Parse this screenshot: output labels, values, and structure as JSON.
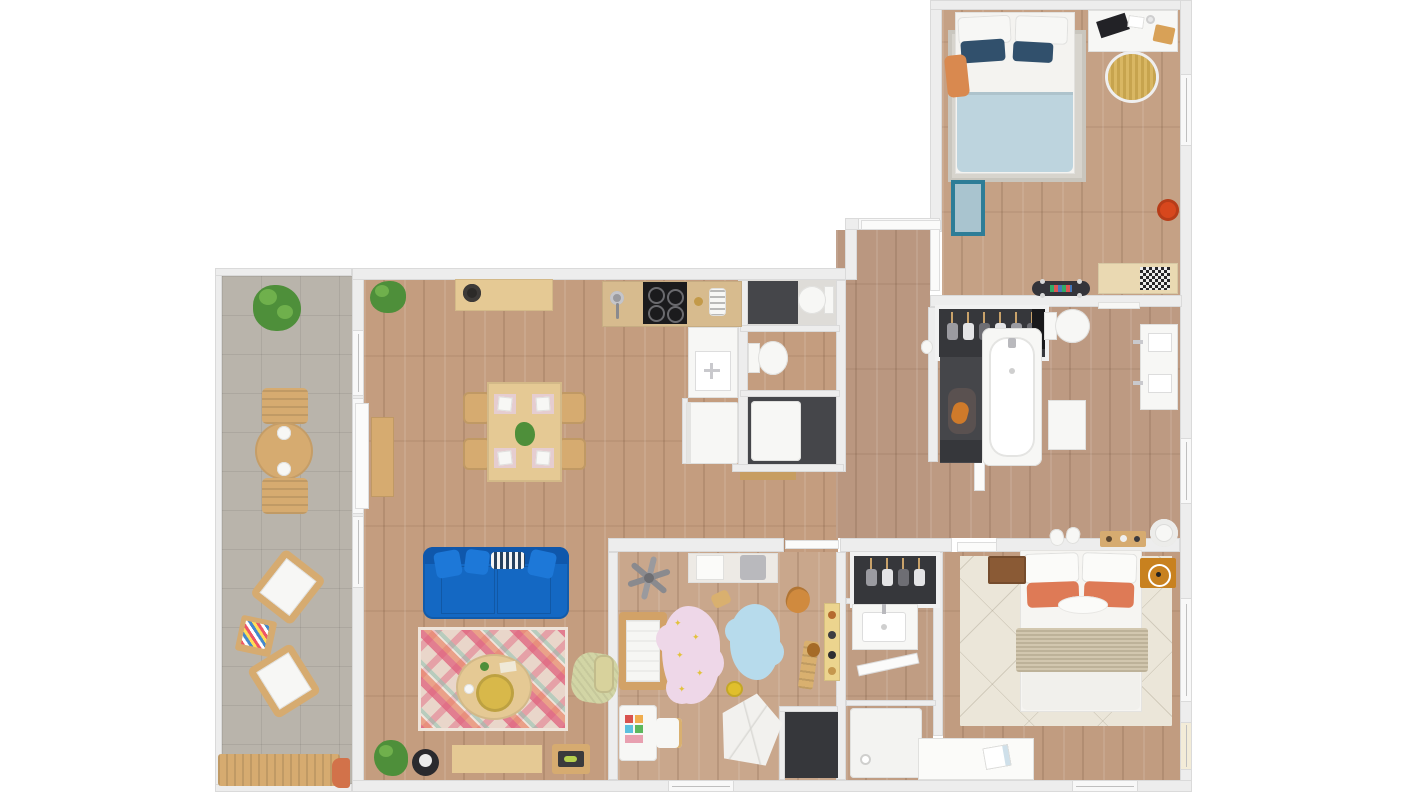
{
  "title": "apartment-floor-plan-3d-top-view",
  "palette": {
    "wall": "#ededed",
    "wall_edge": "#dadada",
    "window_band": "#f8f8f8",
    "wood_main": "#c49d7f",
    "wood_hall": "#ba9780",
    "wood_bath": "#bd9a82",
    "wood_br1": "#c5a185",
    "wood_kids": "#c9a78c",
    "wood_ensuite": "#c09d83",
    "wood_master": "#c19c80",
    "tile": "#b9b4ab",
    "dark_floor": "#45464a",
    "darker_floor": "#36373b",
    "counter_tan": "#d7bb8e",
    "wood_furniture": "#d6ab70",
    "wood_light": "#e5c994",
    "crib_wood": "#d2a267",
    "sofa_blue": "#1468c3",
    "sofa_blue_dark": "#0f57ab",
    "pillow_blue": "#1d78d8",
    "rug_base": "#e9d6ca",
    "rug_pink": "#e0607c",
    "rug_coral": "#ea8566",
    "rug_teal": "#90c3b2",
    "master_rug": "#ebe6d9",
    "throw_beige": "#cdc1a6",
    "coral_pillow": "#de7a56",
    "duvet_blue": "#bdd4de",
    "navy_pillow": "#31506c",
    "gray_rug": "#d7d4cd",
    "pink_cloud": "#eed7e8",
    "blue_cloud": "#b7dbec",
    "star_yellow": "#e2c23c",
    "wicker_yellow": "#d9b763",
    "pouf_red": "#d7471d",
    "pouf_green": "#d2d5a5",
    "amber_nightstand": "#c8811f",
    "brown_nightstand": "#8a5a35",
    "white_furniture": "#f7f7f5",
    "white_edge": "#e0e0de",
    "appliance_black": "#1b1b1d",
    "plant_green": "#4e8f3a",
    "plant_green_light": "#6fb04c",
    "terracotta": "#d2724a",
    "blue_mat": "#a9c4cf",
    "blue_mat_edge": "#2e7d97",
    "gold_tray": "#d8b84a",
    "radio_green": "#b5cf4e",
    "shelf_yellow": "#ecd48e",
    "orange_cushion": "#d9894f",
    "giraffe_orange": "#d08a3e"
  },
  "rooms": [
    {
      "name": "balcony",
      "floor": "gray tile"
    },
    {
      "name": "living-room",
      "floor": "oak plank"
    },
    {
      "name": "kitchen",
      "floor": "oak plank"
    },
    {
      "name": "dining-area",
      "floor": "oak plank"
    },
    {
      "name": "wc",
      "floor": "dark tile"
    },
    {
      "name": "shower-room",
      "floor": "dark tile"
    },
    {
      "name": "entry-hall",
      "floor": "oak plank"
    },
    {
      "name": "bedroom-1",
      "floor": "oak plank"
    },
    {
      "name": "wardrobe-closet",
      "floor": "dark tile"
    },
    {
      "name": "bathroom",
      "floor": "oak plank"
    },
    {
      "name": "kids-room",
      "floor": "oak plank"
    },
    {
      "name": "ensuite-bathroom",
      "floor": "oak plank"
    },
    {
      "name": "master-bedroom",
      "floor": "oak plank"
    },
    {
      "name": "storage-closet",
      "floor": "dark tile"
    }
  ],
  "furniture": {
    "balcony": [
      "potted plant",
      "round dining table",
      "2 outdoor chairs",
      "2 lounge chairs",
      "magazine side table",
      "wood bench",
      "terracotta pot"
    ],
    "living_room": [
      "blue 3-seat sofa",
      "kilim rug",
      "round coffee table with gold tray",
      "green woven pouf",
      "tv bench",
      "robot vacuum",
      "radio side table",
      "floor plant",
      "wall console",
      "storage basket"
    ],
    "kitchen": [
      "sideboard with bowl",
      "counter with sink",
      "induction cooktop",
      "toaster",
      "sink vanity",
      "washing machine",
      "potted plant"
    ],
    "dining_area": [
      "dining table",
      "4 chairs",
      "4 place settings",
      "plant centerpiece"
    ],
    "wc": [
      "dark counter",
      "toilet"
    ],
    "bath_column": [
      "toilet",
      "shower tray",
      "wood threshold"
    ],
    "bedroom_1": [
      "double bed blue bedding",
      "area rug",
      "desk with laptop",
      "wicker chair",
      "blue mat",
      "red pouf",
      "bench with checkered cushion",
      "skateboard",
      "orange cushion"
    ],
    "bathroom": [
      "wardrobe with hangers",
      "bathtub",
      "toilet",
      "towel rail",
      "double sink vanity",
      "stool",
      "laundry pile",
      "shoes",
      "wood tray",
      "bowl"
    ],
    "kids_room": [
      "wall shelf with baskets",
      "mobile toy",
      "crib",
      "pink cloud rug with stars",
      "blue cloud rug",
      "giraffe toy",
      "toy car",
      "toy shelf",
      "play tent",
      "changing table",
      "kids chair",
      "yellow toy",
      "basket"
    ],
    "ensuite_bathroom": [
      "closet with hangers",
      "sink vanity",
      "shower tray",
      "door"
    ],
    "master_bedroom": [
      "double bed coral pillows",
      "cream rug",
      "2 nightstands",
      "alarm clock",
      "desk with notebook",
      "knit throw"
    ]
  }
}
